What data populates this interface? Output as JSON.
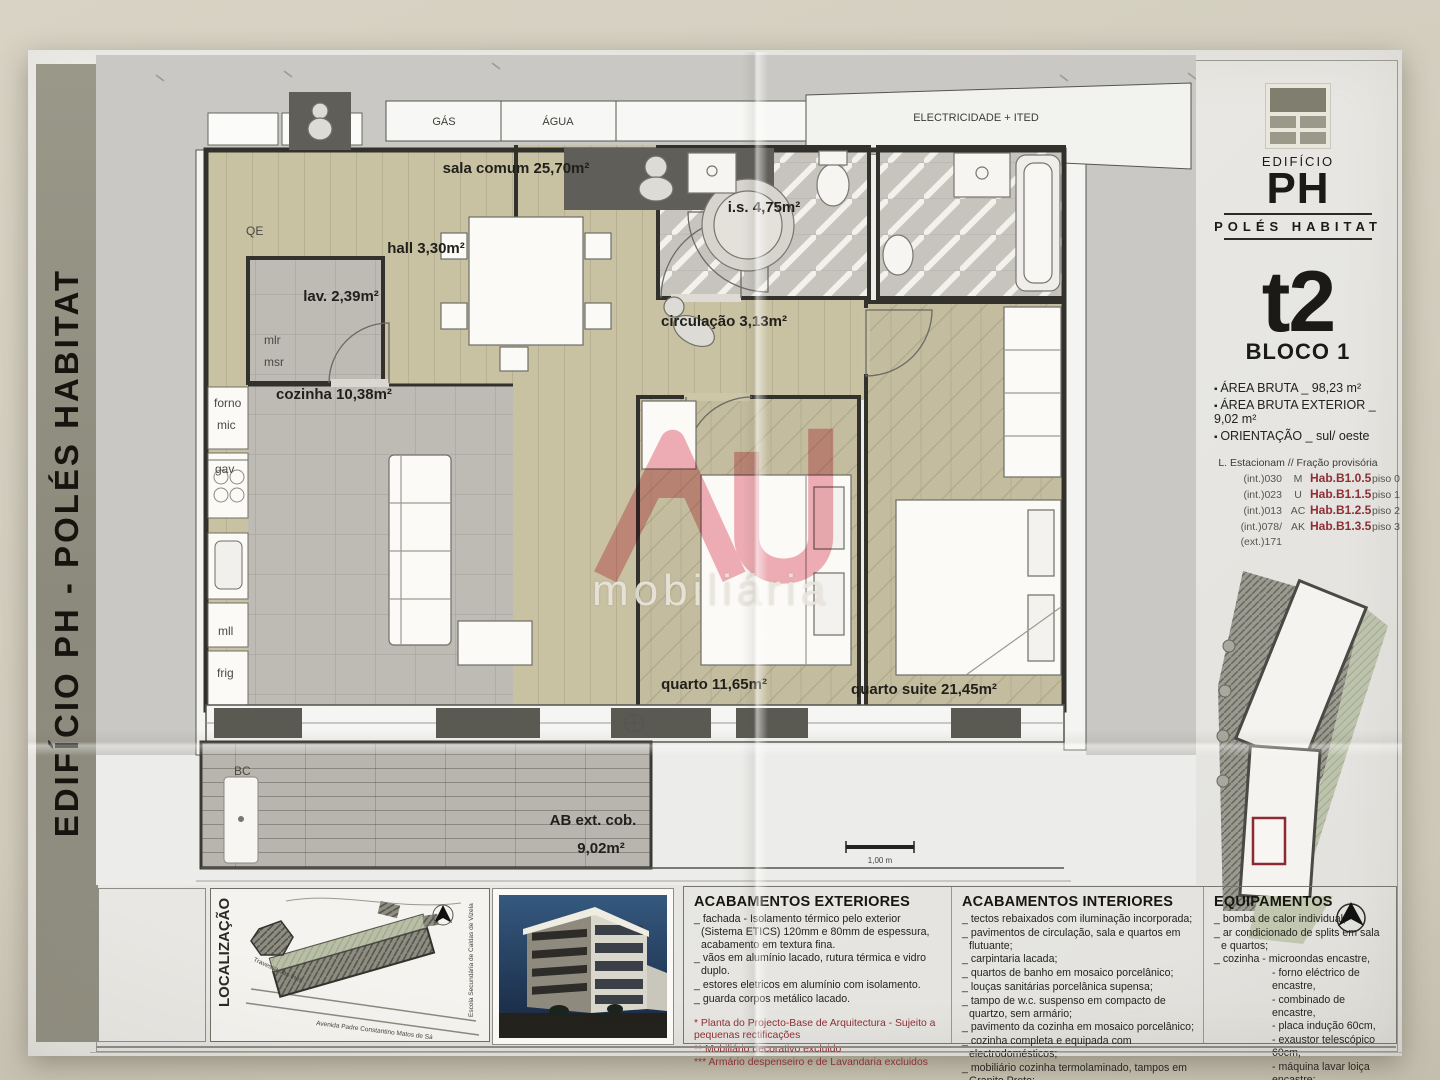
{
  "side_bar": {
    "title": "EDIFÍCIO PH - POLÉS HABITAT"
  },
  "plan": {
    "utilities": {
      "gas": "GÁS",
      "agua": "ÁGUA",
      "elec": "ELECTRICIDADE + ITED"
    },
    "rooms": {
      "sala": "sala comum 25,70m²",
      "hall": "hall 3,30m²",
      "lav": "lav. 2,39m²",
      "cozinha": "cozinha 10,38m²",
      "is": "i.s. 4,75m²",
      "circulacao": "circulação 3,13m²",
      "quarto": "quarto 11,65m²",
      "suite": "quarto suite 21,45m²",
      "terraco_l1": "AB ext. cob.",
      "terraco_l2": "9,02m²"
    },
    "small_labels": {
      "qe": "QE",
      "mlr": "mlr",
      "msr": "msr",
      "forno": "forno",
      "mic": "mic",
      "gav": "gav",
      "mll": "mll",
      "frig": "frig",
      "bc": "BC"
    },
    "scale": "1,00 m"
  },
  "watermark": {
    "text": "mobiliária",
    "color": "#e8808d"
  },
  "info_panel": {
    "brand_small": "EDIFÍCIO",
    "brand_big": "PH",
    "brand_sub": "POLÉS HABITAT",
    "type": "t2",
    "block": "BLOCO 1",
    "bullets": [
      "ÁREA BRUTA _ 98,23 m²",
      "ÁREA BRUTA EXTERIOR _ 9,02 m²",
      "ORIENTAÇÃO _ sul/ oeste"
    ],
    "parking": {
      "header": "L. Estacionam // Fração provisória",
      "rows": [
        {
          "lot": "(int.)030",
          "letter": "M",
          "code": "Hab.B1.0.5",
          "floor": "piso 0"
        },
        {
          "lot": "(int.)023",
          "letter": "U",
          "code": "Hab.B1.1.5",
          "floor": "piso 1"
        },
        {
          "lot": "(int.)013",
          "letter": "AC",
          "code": "Hab.B1.2.5",
          "floor": "piso 2"
        },
        {
          "lot": "(int.)078/ (ext.)171",
          "letter": "AK",
          "code": "Hab.B1.3.5",
          "floor": "piso 3"
        }
      ]
    },
    "accent_red": "#8c2f35"
  },
  "footer": {
    "localizacao_label": "LOCALIZAÇÃO",
    "map_labels": {
      "street1": "Travessa das Inês",
      "street2": "Avenida Padre Constantino Matos de Sá",
      "school": "Escola Secundária de Caldas de Vizela"
    },
    "ext": {
      "title": "ACABAMENTOS EXTERIORES",
      "items": [
        "_ fachada -  Isolamento térmico pelo exterior (Sistema ETICS) 120mm e 80mm de espessura, acabamento em textura fina.",
        "_ vãos em alumínio lacado, rutura térmica e vidro duplo.",
        "_ estores eletricos em alumínio com isolamento.",
        "_ guarda corpos metálico lacado."
      ],
      "notes": [
        "* Planta do Projecto-Base de Arquitectura - Sujeito a pequenas rectificações",
        "** Mobiliário decorativo excluido",
        "*** Armário despenseiro e de Lavandaria excluidos"
      ]
    },
    "int": {
      "title": "ACABAMENTOS INTERIORES",
      "items": [
        "_ tectos rebaixados com iluminação incorporada;",
        "_ pavimentos de circulação, sala e quartos em flutuante;",
        "_ carpintaria lacada;",
        "_ quartos de banho em mosaico porcelânico;",
        "_ louças sanitárias porcelânica supensa;",
        "_ tampo de w.c. suspenso em compacto de quartzo, sem armário;",
        "_ pavimento da cozinha em mosaico porcelânico;",
        "_ cozinha completa e equipada com electrodomésticos;",
        "_ mobiliário cozinha termolaminado, tampos em Granito Preto;"
      ]
    },
    "equip": {
      "title": "EQUIPAMENTOS",
      "items": [
        "_ bomba de calor individual;",
        "_ ar condicionado de splits em sala e quartos;",
        "_ cozinha - microondas encastre,"
      ],
      "subs": [
        "- forno eléctrico de encastre,",
        "- combinado de encastre,",
        "- placa indução 60cm,",
        "- exaustor telescópico 60cm,",
        "- máquina lavar loiça encastre;"
      ]
    }
  }
}
